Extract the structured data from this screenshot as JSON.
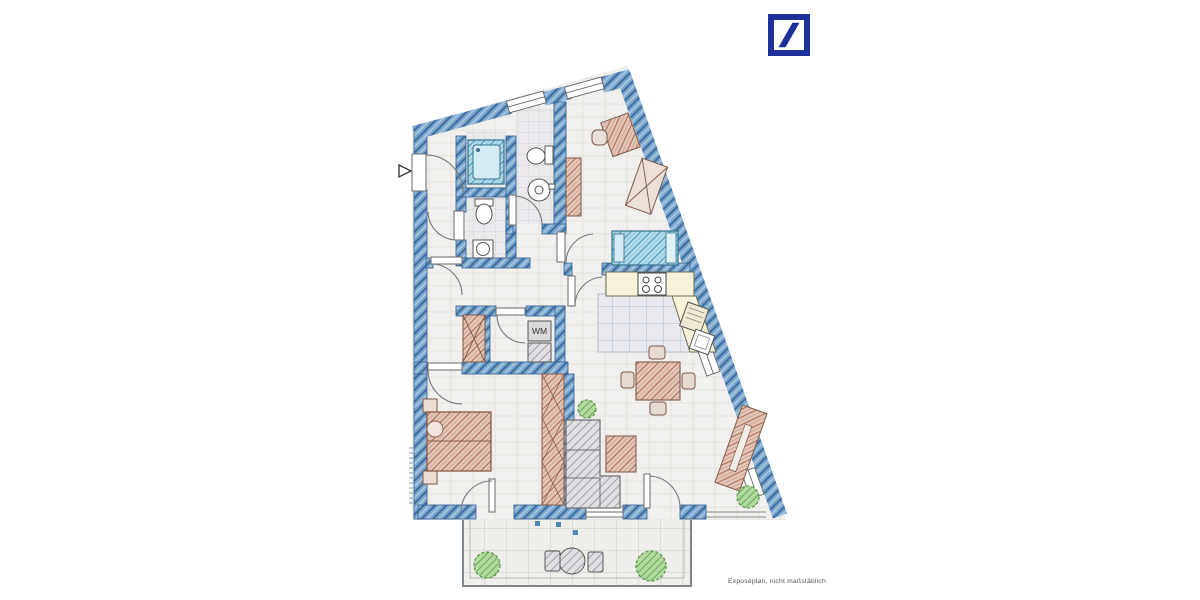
{
  "brand": {
    "logo_icon": "deutsche-bank-slash-logo",
    "logo_color": "#1e3099"
  },
  "floor_plan": {
    "caption": "Exposéplan, nicht maßstäblich",
    "labels": {
      "washing_machine": "WM"
    },
    "colors": {
      "wall_blue": "#6f9ec6",
      "wall_line": "#3e6f9f",
      "furniture_red": "#dcb4a4",
      "bed_cyan": "#abd8e8",
      "sofa_gray": "#dddde0",
      "plant_green": "#a8d595",
      "counter_cream": "#f6f2da",
      "floor": "#f1f0ee"
    },
    "depicted_elements": [
      "entrance-with-arrow",
      "shower-bath",
      "wc-with-toilet-and-sink",
      "second-bathroom",
      "utility-room-washing-machine",
      "built-in-wardrobes",
      "double-bed-bedroom",
      "single-bed-room-with-desk-and-wardrobe",
      "kitchen-counter-stove-fridge",
      "dining-table-with-four-chairs",
      "l-shaped-sofa",
      "coffee-table",
      "sideboard",
      "balcony-with-round-table-two-chairs",
      "plants"
    ]
  }
}
